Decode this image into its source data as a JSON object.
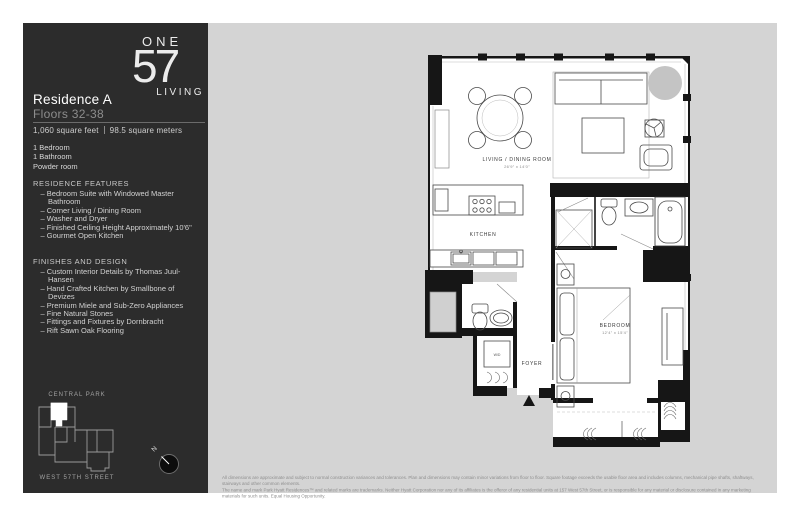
{
  "colors": {
    "sidebar_bg": "#2c2c2c",
    "canvas_bg": "#d4d4d4",
    "wall": "#161616",
    "column_gray": "#c4c4c4"
  },
  "logo": {
    "one": "ONE",
    "number": "57",
    "living": "LIVING"
  },
  "sidebar": {
    "title": "Residence A",
    "subtitle": "Floors 32-38",
    "area_ft": "1,060 square feet",
    "area_m": "98.5 square meters",
    "rooms": [
      "1 Bedroom",
      "1 Bathroom",
      "Powder room"
    ],
    "features_heading": "RESIDENCE FEATURES",
    "features": [
      "Bedroom Suite with Windowed Master Bathroom",
      "Corner Living / Dining Room",
      "Washer and Dryer",
      "Finished Ceiling Height Approximately 10'6\"",
      "Gourmet Open Kitchen"
    ],
    "finishes_heading": "FINISHES AND DESIGN",
    "finishes": [
      "Custom Interior Details by Thomas Juul-Hansen",
      "Hand Crafted Kitchen by Smallbone of Devizes",
      "Premium Miele and Sub-Zero Appliances",
      "Fine Natural Stones",
      "Fittings and Fixtures by Dornbracht",
      "Rift Sawn Oak Flooring"
    ],
    "map": {
      "top_label": "CENTRAL PARK",
      "bottom_label": "WEST 57TH STREET"
    },
    "compass_label": "N"
  },
  "plan": {
    "living": {
      "name": "LIVING / DINING ROOM",
      "dims": "26'9\" x 14'0\""
    },
    "kitchen": {
      "name": "KITCHEN"
    },
    "foyer": {
      "name": "FOYER"
    },
    "bedroom": {
      "name": "BEDROOM",
      "dims": "12'4\" x 15'4\""
    },
    "wd_label": "W/D"
  },
  "disclaimer": {
    "line1": "All dimensions are approximate and subject to normal construction variances and tolerances. Plan and dimensions may contain minor variations from floor to floor. Square footage exceeds the usable floor area and includes columns, mechanical pipe shafts, shaftways, stairways and other common elements.",
    "line2": "The name and mark Park Hyatt Residences™ and related marks are trademarks. Neither Hyatt Corporation nor any of its affiliates is the offeror of any residential units at 157 West 57th Street, or is responsible for any material or disclosure contained in any marketing materials for such units. Equal Housing Opportunity."
  }
}
